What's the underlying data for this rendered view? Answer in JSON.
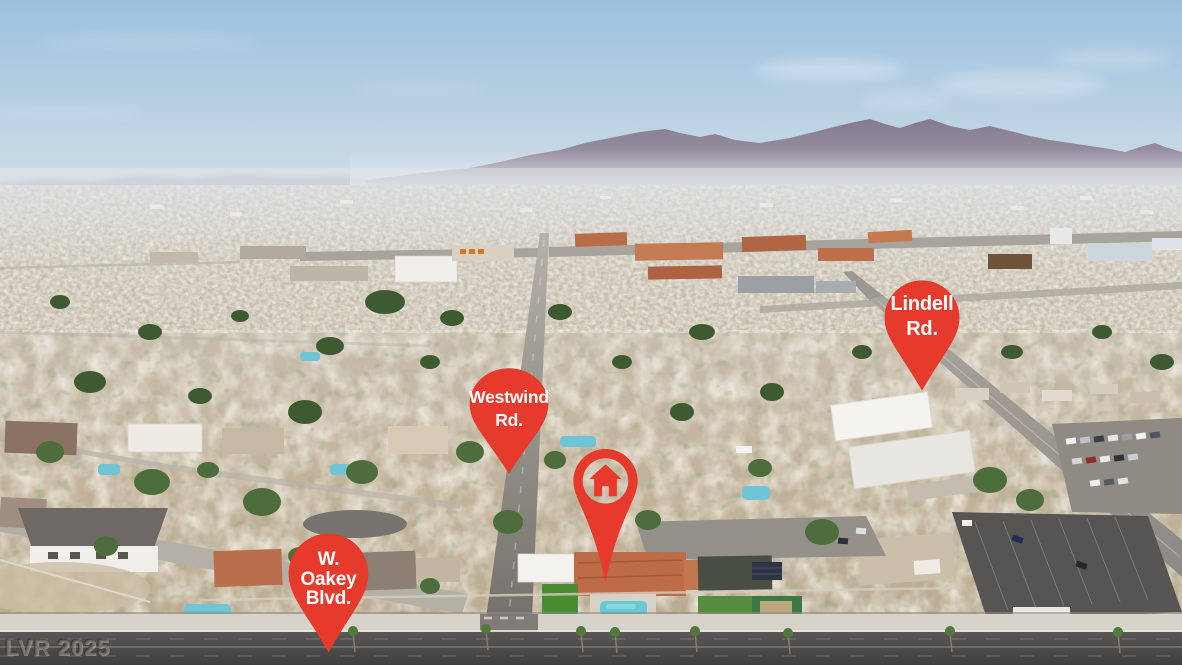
{
  "scene": {
    "description": "Aerial drone photo of a Las Vegas residential neighborhood, mountain range on the horizon, labeled road pins",
    "colors": {
      "pin_red": "#e63a2c",
      "pin_text": "#ffffff",
      "sky_top": "#9cc1e0",
      "mountains": "#8b8194",
      "city_tan": "#c6bba9",
      "asphalt": "#4c4a48",
      "pool_blue": "#6cc8d6"
    }
  },
  "pins": {
    "westwind": {
      "lines": [
        "Westwind",
        "Rd."
      ]
    },
    "lindell": {
      "lines": [
        "Lindell",
        "Rd."
      ]
    },
    "oakey": {
      "lines": [
        "W.",
        "Oakey",
        "Blvd."
      ]
    },
    "home": {
      "icon": "house-icon"
    }
  },
  "watermark": {
    "text": "LVR 2025"
  }
}
